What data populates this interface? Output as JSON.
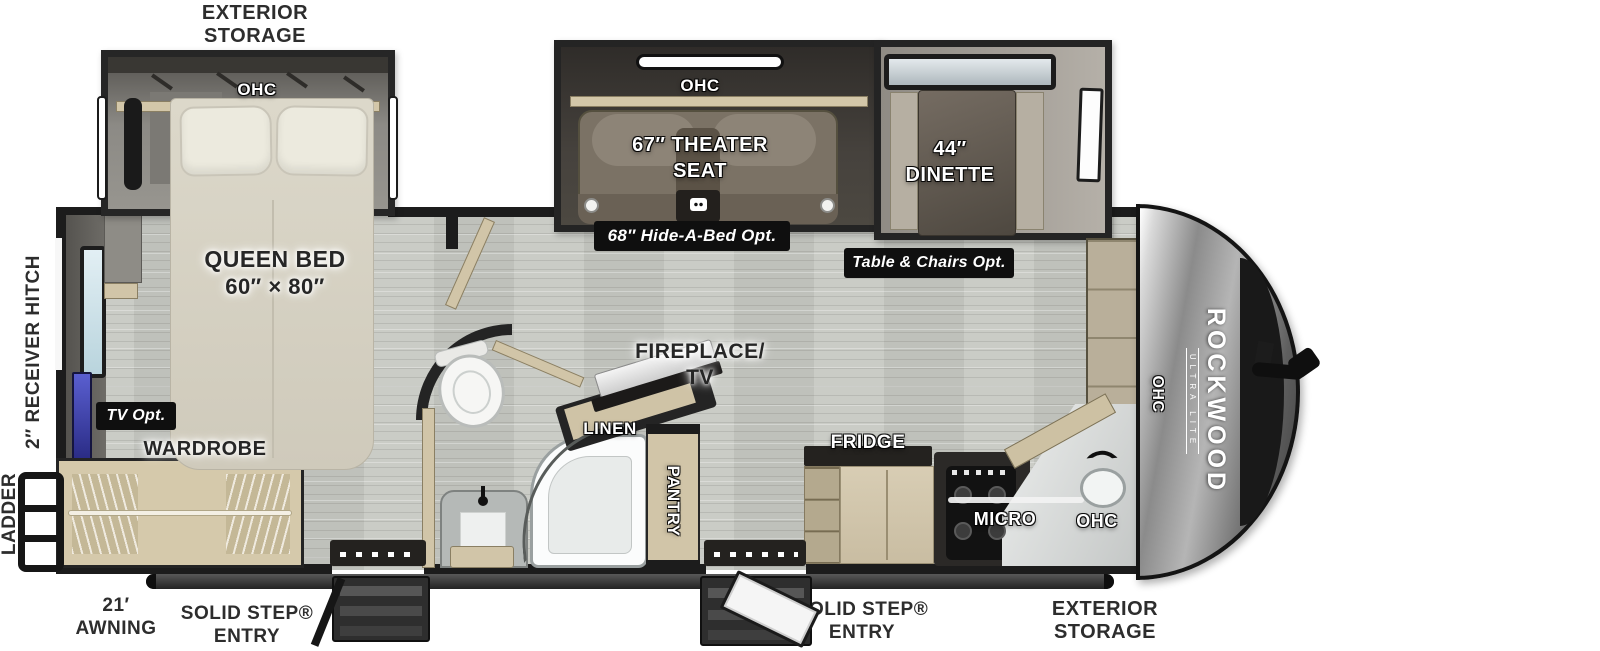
{
  "brand": {
    "name": "ROCKWOOD",
    "series": "ULTRA LITE"
  },
  "labels": {
    "exterior_storage_line1": "EXTERIOR",
    "exterior_storage_line2": "STORAGE",
    "ohc": "OHC",
    "queen_bed_line1": "QUEEN BED",
    "queen_bed_line2": "60″ × 80″",
    "theater_line1": "67″ THEATER",
    "theater_line2": "SEAT",
    "hide_a_bed": "68″ Hide-A-Bed Opt.",
    "dinette_line1": "44″",
    "dinette_line2": "DINETTE",
    "table_chairs": "Table & Chairs Opt.",
    "receiver_hitch": "2″ RECEIVER HITCH",
    "ladder": "LADDER",
    "tv_opt": "TV Opt.",
    "wardrobe": "WARDROBE",
    "fireplace_line1": "FIREPLACE/",
    "fireplace_line2": "TV",
    "linen": "LINEN",
    "pantry": "PANTRY",
    "fridge": "FRIDGE",
    "micro": "MICRO",
    "awning_line1": "21′",
    "awning_line2": "AWNING",
    "solid_step_line1": "SOLID STEP®",
    "solid_step_line2": "ENTRY"
  },
  "colors": {
    "wall": "#1c1c1c",
    "floor": "#c7c9c3",
    "cabinet_tan": "#d1c5a8",
    "slide_dark": "#3e3a36",
    "chip_bg": "#0f0f0f",
    "tv_panel_blue": "#4047b8",
    "window_glass": "#cfe2ea"
  }
}
